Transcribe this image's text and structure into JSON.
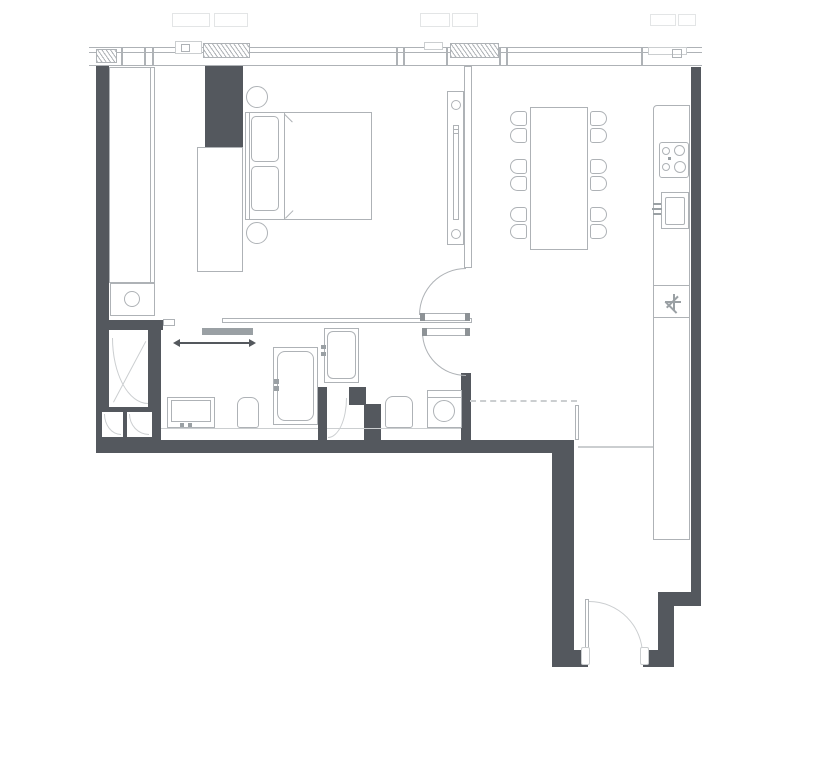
{
  "canvas": {
    "width": 814,
    "height": 768
  },
  "colors": {
    "background": "#ffffff",
    "wall": "#54585e",
    "line": "#aeb2b6",
    "faint": "#cbced0",
    "ghost": "#e3e5e6",
    "fixture": "#9aa0a4",
    "hinge": "#8d9296",
    "arrow": "#54585d"
  },
  "plan": {
    "type": "apartment-floor-plan",
    "orientation": "windows-top, entry-bottom-right",
    "fixtures": {
      "beds": 1,
      "bedside_lamps": 2,
      "wardrobes": 2,
      "dining_tables": 1,
      "dining_chairs": 12,
      "tv_media_units": 1,
      "kitchen_counters": 1,
      "cooktop_burners": 4,
      "sinks": 1,
      "wash_basins": 1,
      "toilets": 2,
      "showers": 3,
      "washing_machines": 2,
      "swing_doors": 3,
      "sliding_doors": 1,
      "entry_doors": 1,
      "window_vents": 3
    }
  }
}
